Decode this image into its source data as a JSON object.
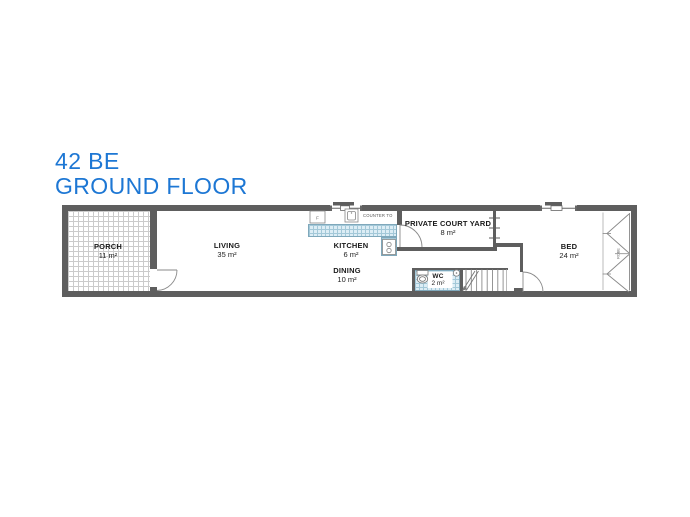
{
  "title": {
    "line1": "42 BE",
    "line2": "GROUND FLOOR"
  },
  "plan": {
    "rooms": {
      "porch": {
        "name": "PORCH",
        "area": "11 m²"
      },
      "living": {
        "name": "LIVING",
        "area": "35 m²"
      },
      "kitchen": {
        "name": "KITCHEN",
        "area": "6 m²"
      },
      "dining": {
        "name": "DINING",
        "area": "10 m²"
      },
      "courtyard": {
        "name": "PRIVATE COURT YARD",
        "area": "8 m²"
      },
      "wc": {
        "name": "WC",
        "area": "2 m²"
      },
      "bed": {
        "name": "BED",
        "area": "24 m²"
      }
    },
    "annotations": {
      "counter": "COUNTER TO",
      "fridge": "F",
      "robe": "ROBE"
    },
    "colors": {
      "title_blue": "#1d77d4",
      "wall_gray": "#5e5e5e",
      "tile_blue": "#dcedf5"
    }
  }
}
